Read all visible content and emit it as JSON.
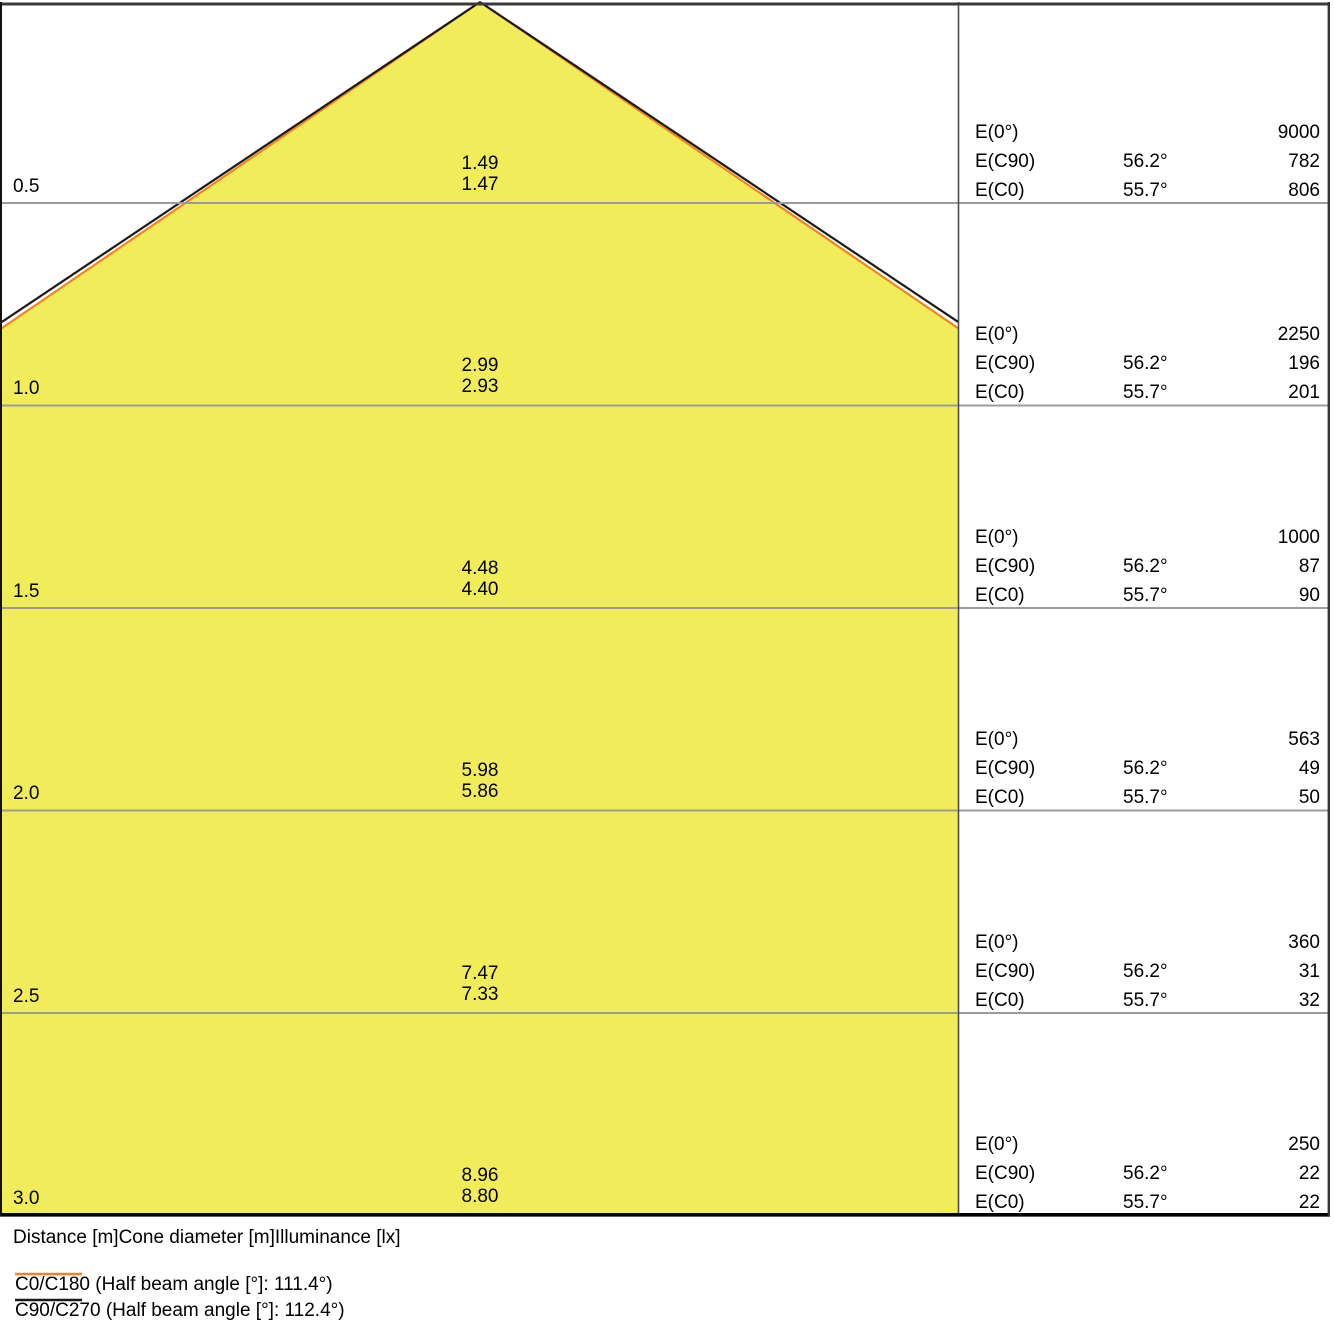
{
  "colors": {
    "cone_fill": "#F1ED5A",
    "c0_line": "#F5821E",
    "c90_line": "#1A1A1A",
    "grid_line": "#9C9C9C"
  },
  "rows": [
    {
      "distance": "0.5",
      "dia_c90": "1.49",
      "dia_c0": "1.47",
      "e0_label": "E(0°)",
      "e0_value": "9000",
      "ec90_label": "E(C90)",
      "ec90_angle": "56.2°",
      "ec90_value": "782",
      "ec0_label": "E(C0)",
      "ec0_angle": "55.7°",
      "ec0_value": "806"
    },
    {
      "distance": "1.0",
      "dia_c90": "2.99",
      "dia_c0": "2.93",
      "e0_label": "E(0°)",
      "e0_value": "2250",
      "ec90_label": "E(C90)",
      "ec90_angle": "56.2°",
      "ec90_value": "196",
      "ec0_label": "E(C0)",
      "ec0_angle": "55.7°",
      "ec0_value": "201"
    },
    {
      "distance": "1.5",
      "dia_c90": "4.48",
      "dia_c0": "4.40",
      "e0_label": "E(0°)",
      "e0_value": "1000",
      "ec90_label": "E(C90)",
      "ec90_angle": "56.2°",
      "ec90_value": "87",
      "ec0_label": "E(C0)",
      "ec0_angle": "55.7°",
      "ec0_value": "90"
    },
    {
      "distance": "2.0",
      "dia_c90": "5.98",
      "dia_c0": "5.86",
      "e0_label": "E(0°)",
      "e0_value": "563",
      "ec90_label": "E(C90)",
      "ec90_angle": "56.2°",
      "ec90_value": "49",
      "ec0_label": "E(C0)",
      "ec0_angle": "55.7°",
      "ec0_value": "50"
    },
    {
      "distance": "2.5",
      "dia_c90": "7.47",
      "dia_c0": "7.33",
      "e0_label": "E(0°)",
      "e0_value": "360",
      "ec90_label": "E(C90)",
      "ec90_angle": "56.2°",
      "ec90_value": "31",
      "ec0_label": "E(C0)",
      "ec0_angle": "55.7°",
      "ec0_value": "32"
    },
    {
      "distance": "3.0",
      "dia_c90": "8.96",
      "dia_c0": "8.80",
      "e0_label": "E(0°)",
      "e0_value": "250",
      "ec90_label": "E(C90)",
      "ec90_angle": "56.2°",
      "ec90_value": "22",
      "ec0_label": "E(C0)",
      "ec0_angle": "55.7°",
      "ec0_value": "22"
    }
  ],
  "footer": {
    "caption": "Distance [m]Cone diameter [m]Illuminance [lx]"
  },
  "legend": [
    {
      "label": "C0/C180 (Half beam angle [°]: 111.4°)",
      "color": "#F5821E"
    },
    {
      "label": "C90/C270 (Half beam angle [°]: 112.4°)",
      "color": "#1A1A1A"
    }
  ],
  "chart_data": {
    "type": "area",
    "subtype": "luminous-cone-diagram",
    "columns": [
      "Distance [m]",
      "Cone diameter [m]",
      "Illuminance [lx]"
    ],
    "distances_m": [
      0.5,
      1.0,
      1.5,
      2.0,
      2.5,
      3.0
    ],
    "E0_lx": [
      9000,
      2250,
      1000,
      563,
      360,
      250
    ],
    "series": [
      {
        "name": "C0/C180",
        "half_beam_angle_deg": 111.4,
        "e_angle_deg": 55.7,
        "cone_diameter_m": [
          1.47,
          2.93,
          4.4,
          5.86,
          7.33,
          8.8
        ],
        "illuminance_lx": [
          806,
          201,
          90,
          50,
          32,
          22
        ],
        "color": "#F5821E"
      },
      {
        "name": "C90/C270",
        "half_beam_angle_deg": 112.4,
        "e_angle_deg": 56.2,
        "cone_diameter_m": [
          1.49,
          2.99,
          4.48,
          5.98,
          7.47,
          8.96
        ],
        "illuminance_lx": [
          782,
          196,
          87,
          49,
          31,
          22
        ],
        "color": "#1A1A1A"
      }
    ],
    "legend_position": "bottom",
    "grid": true
  }
}
